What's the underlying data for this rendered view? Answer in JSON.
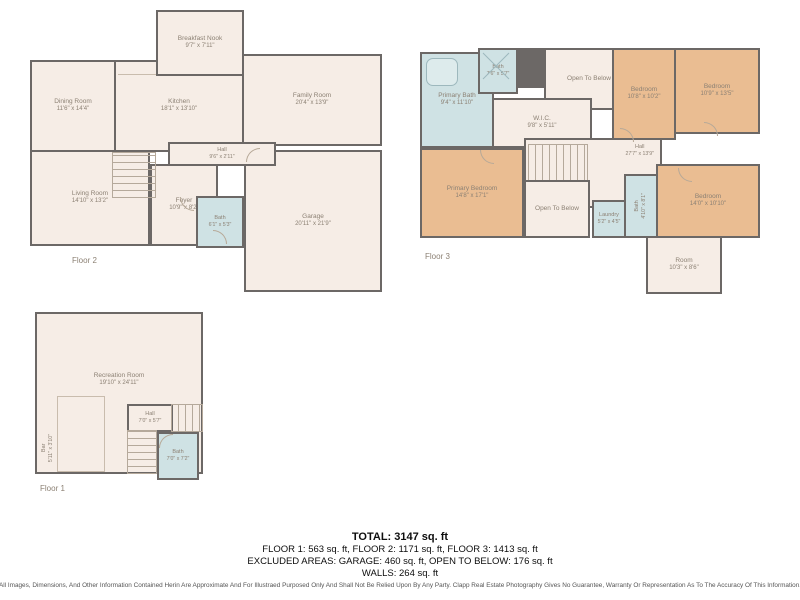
{
  "colors": {
    "wall": "#6c6866",
    "floor": "#f6ede6",
    "bedroom": "#eabd92",
    "bath": "#cfe2e4",
    "label": "#8c8174"
  },
  "floors": [
    {
      "label": "Floor 2",
      "rooms": [
        {
          "name": "Dining Room",
          "dims": "11'6\" x 14'4\""
        },
        {
          "name": "Kitchen",
          "dims": "18'1\" x 13'10\""
        },
        {
          "name": "Breakfast Nook",
          "dims": "9'7\" x 7'11\""
        },
        {
          "name": "Family Room",
          "dims": "20'4\" x 13'9\""
        },
        {
          "name": "Living Room",
          "dims": "14'10\" x 13'2\""
        },
        {
          "name": "Hall",
          "dims": "9'6\" x 2'11\""
        },
        {
          "name": "Foyer",
          "dims": "10'9\" x 8'2\""
        },
        {
          "name": "Bath",
          "dims": "6'1\" x 5'3\""
        },
        {
          "name": "Garage",
          "dims": "20'11\" x 21'9\""
        }
      ]
    },
    {
      "label": "Floor 3",
      "rooms": [
        {
          "name": "Primary Bath",
          "dims": "9'4\" x 11'10\""
        },
        {
          "name": "Bath",
          "dims": "7'6\" x 5'7\""
        },
        {
          "name": "W.I.C.",
          "dims": "9'8\" x 5'11\""
        },
        {
          "name": "Open To Below",
          "dims": ""
        },
        {
          "name": "Bedroom",
          "dims": "10'8\" x 10'2\""
        },
        {
          "name": "Bedroom",
          "dims": "10'9\" x 13'5\""
        },
        {
          "name": "Hall",
          "dims": "27'7\" x 13'9\""
        },
        {
          "name": "Primary Bedroom",
          "dims": "14'8\" x 17'1\""
        },
        {
          "name": "Open To Below",
          "dims": ""
        },
        {
          "name": "Laundry",
          "dims": "5'2\" x 4'5\""
        },
        {
          "name": "Bath",
          "dims": "4'10\" x 8'1\""
        },
        {
          "name": "Bedroom",
          "dims": "14'0\" x 10'10\""
        },
        {
          "name": "Room",
          "dims": "10'3\" x 8'6\""
        }
      ]
    },
    {
      "label": "Floor 1",
      "rooms": [
        {
          "name": "Recreation Room",
          "dims": "19'10\" x 24'11\""
        },
        {
          "name": "Hall",
          "dims": "7'0\" x 5'7\""
        },
        {
          "name": "Bath",
          "dims": "7'0\" x 7'2\""
        },
        {
          "name": "Bar",
          "dims": "5'11\" x 3'10\""
        }
      ]
    }
  ],
  "summary": {
    "total": "TOTAL: 3147 sq. ft",
    "floors_line": "FLOOR 1: 563 sq. ft, FLOOR 2: 1171 sq. ft, FLOOR 3: 1413 sq. ft",
    "excluded_line": "EXCLUDED AREAS: GARAGE: 460 sq. ft, OPEN TO BELOW: 176 sq. ft",
    "walls_line": "WALLS: 264 sq. ft"
  },
  "disclaimer": "All Images, Dimensions, And Other Information Contained Herin Are Approximate And For Illustraed Purposed Only And Shall Not Be Relied Upon By Any Party. Clapp Real Estate Photography Gives No Guarantee, Warranty Or Representation As To The Accuracy Of This Information."
}
